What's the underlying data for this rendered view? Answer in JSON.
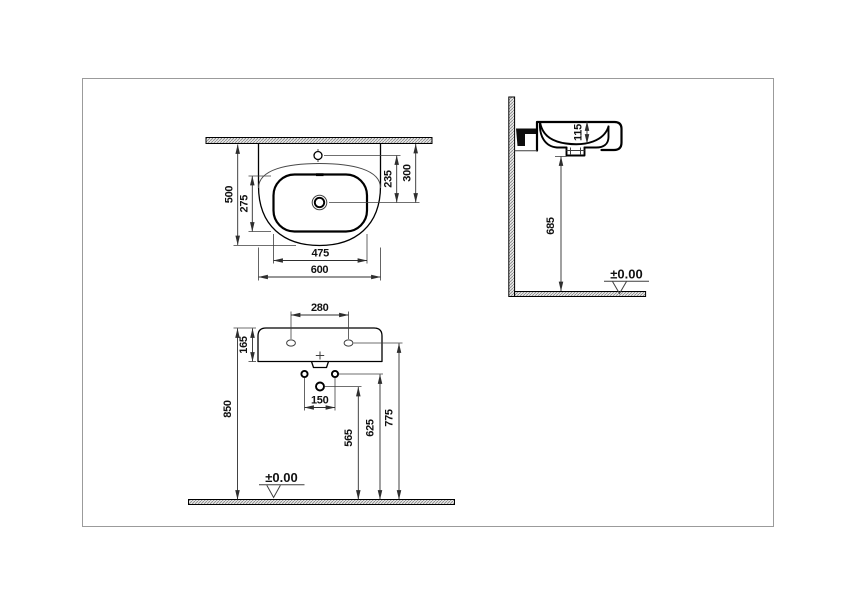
{
  "drawing": {
    "plan_view": {
      "label_overall_width": "600",
      "label_bowl_width": "475",
      "label_overall_depth": "500",
      "label_bowl_depth": "275",
      "label_tap_to_drain": "235",
      "label_wall_to_drain": "300"
    },
    "side_view": {
      "label_bowl_inner_depth": "115",
      "label_underside_height": "685",
      "datum": "±0.00"
    },
    "front_view": {
      "label_tap_hole_spacing": "280",
      "label_basin_height": "165",
      "label_rim_height": "850",
      "label_fixing_spacing": "150",
      "label_supply_height": "565",
      "label_fixing_height": "625",
      "label_wall_fixing_height": "775",
      "datum": "±0.00"
    },
    "colors": {
      "line": "#000000",
      "dimension_line": "#2e2e2e",
      "page_border": "#9b9b9b",
      "hatch": "#8a8a8a",
      "background": "#ffffff"
    }
  }
}
